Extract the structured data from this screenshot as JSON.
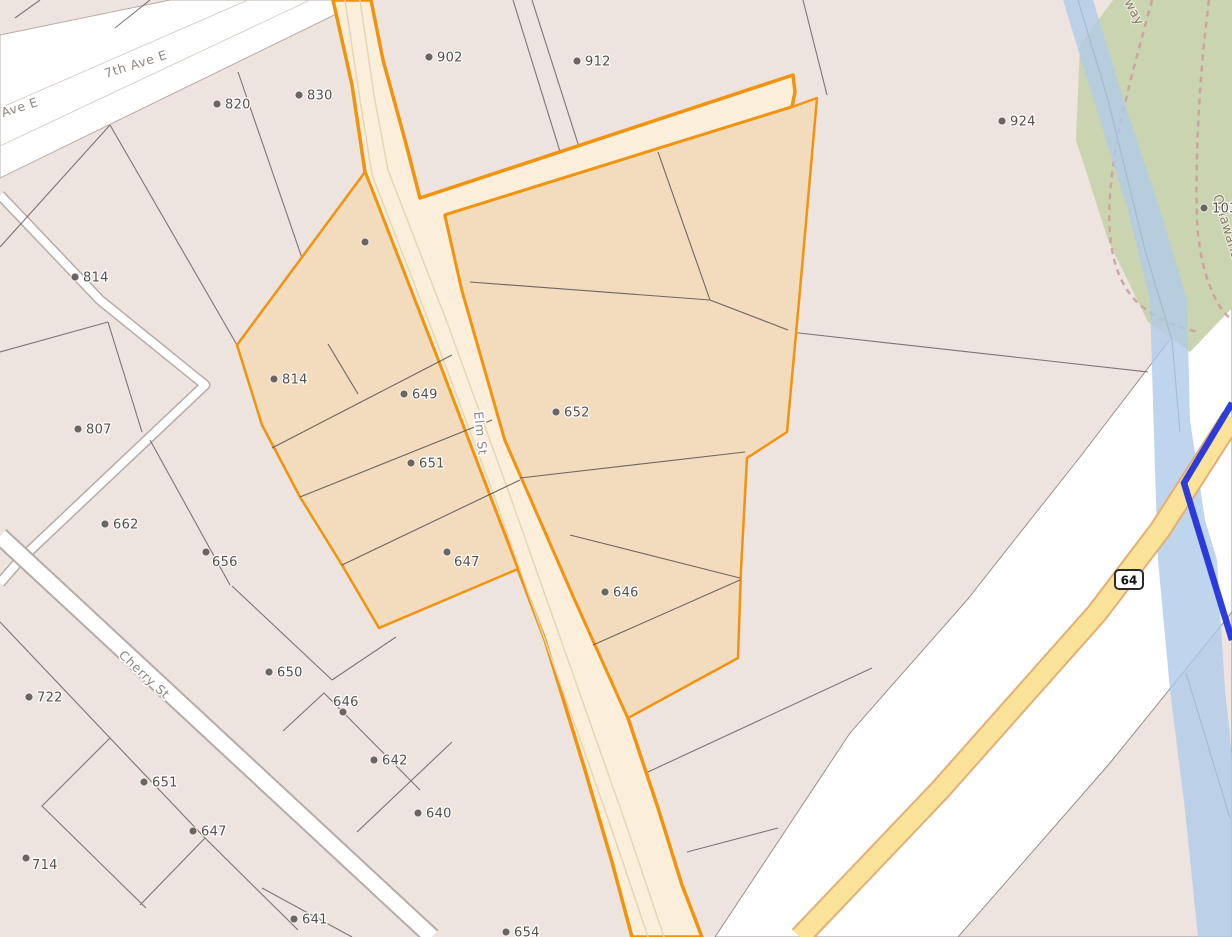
{
  "map": {
    "route_shield": {
      "number": "64",
      "x": 1129,
      "y": 580
    },
    "streets": [
      {
        "name": "7th Ave E",
        "x": 106,
        "y": 78,
        "rotate": -17.5,
        "class": "street-text"
      },
      {
        "name": "Ave E",
        "x": 3,
        "y": 117,
        "rotate": -17.5,
        "class": "street-text"
      },
      {
        "name": "Elm St",
        "x": 474,
        "y": 412,
        "rotate": 84,
        "class": "street-text"
      },
      {
        "name": "Cherry St",
        "x": 118,
        "y": 656,
        "rotate": 43,
        "class": "street-text"
      },
      {
        "name": "Oklawaha Greenway",
        "x": 1213,
        "y": 196,
        "rotate": 73,
        "class": "green-text"
      },
      {
        "name": "way",
        "x": 1124,
        "y": 2,
        "rotate": 62,
        "class": "green-text"
      }
    ],
    "parcel_labels": [
      {
        "text": "902",
        "x": 429,
        "y": 57
      },
      {
        "text": "912",
        "x": 577,
        "y": 61
      },
      {
        "text": "820",
        "x": 217,
        "y": 104
      },
      {
        "text": "830",
        "x": 299,
        "y": 95
      },
      {
        "text": "924",
        "x": 1002,
        "y": 121
      },
      {
        "text": "814",
        "x": 75,
        "y": 277
      },
      {
        "text": "",
        "x": 365,
        "y": 242
      },
      {
        "text": "814",
        "x": 274,
        "y": 379
      },
      {
        "text": "807",
        "x": 78,
        "y": 429
      },
      {
        "text": "649",
        "x": 404,
        "y": 394
      },
      {
        "text": "652",
        "x": 556,
        "y": 412
      },
      {
        "text": "651",
        "x": 411,
        "y": 463
      },
      {
        "text": "662",
        "x": 105,
        "y": 524
      },
      {
        "text": "656",
        "x": 206,
        "y": 552,
        "dx": 6,
        "dy": 14
      },
      {
        "text": "647",
        "x": 447,
        "y": 552,
        "dx": 7,
        "dy": 14
      },
      {
        "text": "646",
        "x": 605,
        "y": 592
      },
      {
        "text": "650",
        "x": 269,
        "y": 672
      },
      {
        "text": "722",
        "x": 29,
        "y": 697
      },
      {
        "text": "646",
        "x": 343,
        "y": 712,
        "dx": -10,
        "dy": -6
      },
      {
        "text": "642",
        "x": 374,
        "y": 760
      },
      {
        "text": "640",
        "x": 418,
        "y": 813
      },
      {
        "text": "651",
        "x": 144,
        "y": 782
      },
      {
        "text": "647",
        "x": 193,
        "y": 831
      },
      {
        "text": "714",
        "x": 26,
        "y": 858,
        "dx": 6,
        "dy": 11
      },
      {
        "text": "641",
        "x": 294,
        "y": 919
      },
      {
        "text": "654",
        "x": 506,
        "y": 932
      },
      {
        "text": "103",
        "x": 1204,
        "y": 208
      }
    ],
    "colors": {
      "parcel_fill": "#EDE4E0",
      "selection_orange": "#F1930D",
      "selected_parcel_fill": "#F3DBBE",
      "selected_road_fill": "#FBEEDA",
      "greenway_fill": "#CBD4B0",
      "river_fill": "#AFCBE9",
      "boundary_blue": "#1D2FDB",
      "highway_yellow": "#FAE398",
      "trail_pink": "#CE9E9E"
    }
  }
}
